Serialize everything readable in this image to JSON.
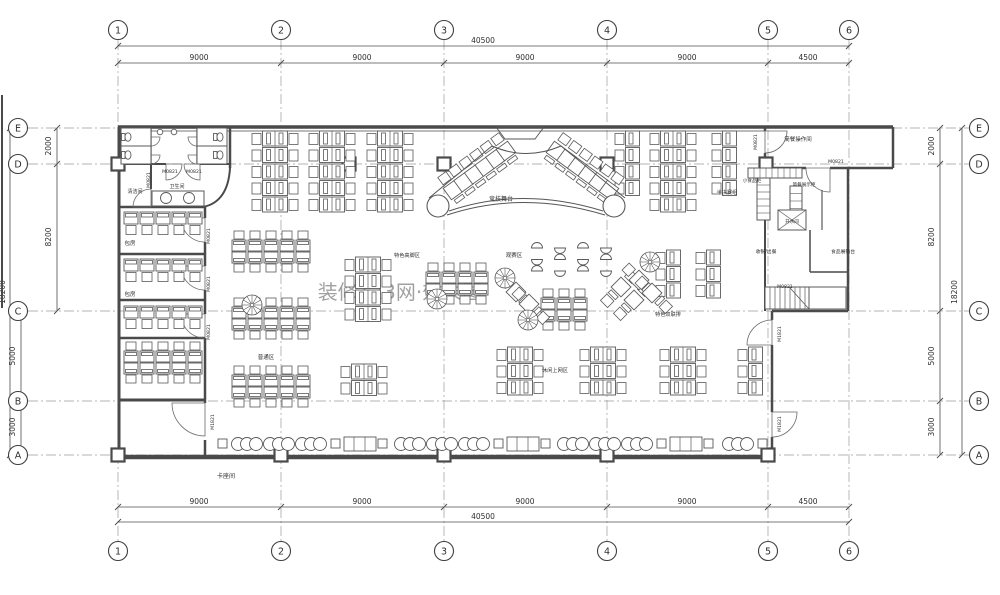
{
  "canvas": {
    "w": 1000,
    "h": 595,
    "bg": "#ffffff"
  },
  "colors": {
    "wall": "#4a4a4a",
    "line": "#555555",
    "thin": "#6a6a6a",
    "grid": "#9a9a9a",
    "dim": "#4f4f4f",
    "furn": "#5a5a5a",
    "text": "#2e2e2e",
    "watermark": "#cfc2c2"
  },
  "grid": {
    "cols": [
      [
        "1",
        118
      ],
      [
        "2",
        281
      ],
      [
        "3",
        444
      ],
      [
        "4",
        607
      ],
      [
        "5",
        768
      ],
      [
        "6",
        849
      ]
    ],
    "rows": [
      [
        "E",
        128
      ],
      [
        "D",
        164
      ],
      [
        "C",
        311
      ],
      [
        "B",
        401
      ],
      [
        "A",
        455
      ]
    ],
    "bubble_r": 9.5,
    "top_y": 30,
    "bot_y": 551,
    "left_x": 18,
    "right_x": 979,
    "line_top": 40,
    "line_bot": 541,
    "line_left": 28,
    "line_right": 969
  },
  "dims": {
    "h": [
      {
        "y": 46,
        "x1": 118,
        "x2": 849,
        "ticks": [
          118,
          849
        ],
        "labels": [
          {
            "t": "40500",
            "x": 483
          }
        ]
      },
      {
        "y": 63,
        "x1": 118,
        "x2": 849,
        "ticks": [
          118,
          281,
          444,
          607,
          768,
          849
        ],
        "labels": [
          {
            "t": "9000",
            "x": 199
          },
          {
            "t": "9000",
            "x": 362
          },
          {
            "t": "9000",
            "x": 525
          },
          {
            "t": "9000",
            "x": 687
          },
          {
            "t": "4500",
            "x": 808
          }
        ]
      },
      {
        "y": 507,
        "x1": 118,
        "x2": 849,
        "ticks": [
          118,
          281,
          444,
          607,
          768,
          849
        ],
        "labels": [
          {
            "t": "9000",
            "x": 199
          },
          {
            "t": "9000",
            "x": 362
          },
          {
            "t": "9000",
            "x": 525
          },
          {
            "t": "9000",
            "x": 687
          },
          {
            "t": "4500",
            "x": 808
          }
        ]
      },
      {
        "y": 522,
        "x1": 118,
        "x2": 849,
        "ticks": [
          118,
          849
        ],
        "labels": [
          {
            "t": "40500",
            "x": 483
          }
        ]
      }
    ],
    "v": [
      {
        "x": 57,
        "y1": 128,
        "y2": 311,
        "ticks": [
          128,
          164,
          311
        ],
        "labels": [
          {
            "t": "2000",
            "y": 146
          },
          {
            "t": "8200",
            "y": 237
          }
        ],
        "lx": 51
      },
      {
        "x": 21,
        "y1": 311,
        "y2": 455,
        "ticks": [
          311,
          401,
          455
        ],
        "labels": [
          {
            "t": "5000",
            "y": 356
          },
          {
            "t": "3000",
            "y": 427
          }
        ],
        "lx": 15
      },
      {
        "x": 10,
        "y1": 128,
        "y2": 455,
        "ticks": [
          128,
          455
        ],
        "labels": [
          {
            "t": "18200",
            "y": 292
          }
        ],
        "lx": 5
      },
      {
        "x": 940,
        "y1": 128,
        "y2": 455,
        "ticks": [
          128,
          164,
          311,
          401,
          455
        ],
        "labels": [
          {
            "t": "2000",
            "y": 146
          },
          {
            "t": "8200",
            "y": 237
          },
          {
            "t": "5000",
            "y": 356
          },
          {
            "t": "3000",
            "y": 427
          }
        ],
        "lx": 934
      },
      {
        "x": 962,
        "y1": 128,
        "y2": 455,
        "ticks": [
          128,
          455
        ],
        "labels": [
          {
            "t": "18200",
            "y": 292
          }
        ],
        "lx": 957
      }
    ]
  },
  "walls": [
    [
      118,
      127,
      893,
      127,
      3.5
    ],
    [
      118,
      131,
      765,
      131,
      0.8
    ],
    [
      119,
      127,
      119,
      456,
      3
    ],
    [
      118,
      457,
      773,
      457,
      4.5
    ],
    [
      772,
      311,
      772,
      320,
      2.5
    ],
    [
      772,
      345,
      772,
      412,
      2.5
    ],
    [
      772,
      437,
      772,
      457,
      2.5
    ],
    [
      848,
      168,
      848,
      311,
      2.5
    ],
    [
      772,
      311,
      848,
      311,
      2.5
    ],
    [
      893,
      127,
      893,
      168,
      2.5
    ],
    [
      765,
      168,
      806,
      168,
      2.5
    ],
    [
      830,
      168,
      893,
      168,
      2.5
    ],
    [
      765,
      127,
      765,
      131,
      2.5
    ],
    [
      765,
      153,
      765,
      168,
      2.5
    ],
    [
      765,
      168,
      765,
      311,
      2
    ],
    [
      230,
      127,
      230,
      168,
      2.5
    ],
    [
      119,
      164,
      151,
      164,
      2
    ],
    [
      151,
      164,
      166,
      164,
      2
    ],
    [
      200,
      164,
      230,
      164,
      2
    ],
    [
      151,
      164,
      151,
      189,
      2
    ],
    [
      119,
      207,
      205,
      207,
      2.5
    ],
    [
      119,
      254,
      205,
      254,
      2.5
    ],
    [
      119,
      300,
      205,
      300,
      2.5
    ],
    [
      119,
      338,
      205,
      338,
      2.5
    ],
    [
      119,
      400,
      205,
      400,
      3
    ],
    [
      205,
      207,
      205,
      218,
      2.5
    ],
    [
      205,
      242,
      205,
      266,
      2.5
    ],
    [
      205,
      290,
      205,
      314,
      2.5
    ],
    [
      205,
      338,
      205,
      403,
      2.5
    ],
    [
      205,
      440,
      205,
      456,
      2.5
    ],
    [
      151,
      127,
      151,
      164,
      1.3
    ],
    [
      197,
      127,
      197,
      164,
      1.3
    ],
    [
      810,
      230,
      810,
      272,
      1.5
    ],
    [
      810,
      272,
      847,
      272,
      1.5
    ]
  ],
  "wall_paths": [
    {
      "d": "M230,168 Q228,202 203,207",
      "w": 2
    }
  ],
  "doors": [
    [
      205,
      218,
      24,
      90,
      180
    ],
    [
      205,
      266,
      24,
      90,
      180
    ],
    [
      205,
      314,
      24,
      90,
      180
    ],
    [
      205,
      403,
      33,
      90,
      180
    ],
    [
      151,
      207,
      18,
      180,
      270
    ],
    [
      166,
      164,
      16,
      0,
      90
    ],
    [
      200,
      164,
      16,
      90,
      180
    ],
    [
      151,
      137,
      9,
      0,
      90
    ],
    [
      151,
      155,
      9,
      0,
      90
    ],
    [
      197,
      137,
      9,
      90,
      180
    ],
    [
      197,
      155,
      9,
      90,
      180
    ],
    [
      765,
      131,
      22,
      0,
      90
    ],
    [
      830,
      168,
      24,
      90,
      180
    ],
    [
      772,
      345,
      25,
      180,
      270
    ],
    [
      772,
      412,
      25,
      0,
      90
    ]
  ],
  "columns": [
    [
      118,
      164
    ],
    [
      349,
      164
    ],
    [
      444,
      164
    ],
    [
      607,
      164
    ],
    [
      766,
      164
    ],
    [
      118,
      455
    ],
    [
      281,
      455
    ],
    [
      444,
      455
    ],
    [
      607,
      455
    ],
    [
      768,
      455
    ]
  ],
  "cells": [
    [
      121,
      128,
      30,
      18
    ],
    [
      121,
      146,
      30,
      18
    ],
    [
      197,
      128,
      30,
      18
    ],
    [
      197,
      146,
      30,
      18
    ]
  ],
  "toilet_fixtures": [
    [
      128,
      137
    ],
    [
      128,
      155
    ],
    [
      220,
      137
    ],
    [
      220,
      155
    ]
  ],
  "urinals": [
    [
      160,
      132
    ],
    [
      174,
      132
    ]
  ],
  "sink": {
    "x": 152,
    "y": 191,
    "w": 52,
    "h": 15,
    "taps": [
      [
        166,
        198
      ],
      [
        189,
        198
      ]
    ]
  },
  "furniture": {
    "vclusters": [
      [
        252,
        131,
        5,
        0
      ],
      [
        309,
        131,
        5,
        0
      ],
      [
        367,
        131,
        5,
        0
      ],
      [
        615,
        131,
        4,
        1
      ],
      [
        650,
        131,
        5,
        0
      ],
      [
        712,
        131,
        4,
        1
      ],
      [
        345,
        257,
        4,
        0
      ],
      [
        656,
        250,
        3,
        1
      ],
      [
        696,
        250,
        3,
        1
      ],
      [
        497,
        347,
        3,
        0
      ],
      [
        580,
        347,
        3,
        0
      ],
      [
        660,
        347,
        3,
        0
      ],
      [
        738,
        347,
        3,
        1
      ],
      [
        341,
        364,
        2,
        0
      ]
    ],
    "hclusters": [
      [
        124,
        212,
        5,
        "s"
      ],
      [
        124,
        259,
        5,
        "s"
      ],
      [
        124,
        306,
        5,
        "s"
      ],
      [
        124,
        342,
        5,
        "d"
      ],
      [
        232,
        231,
        5,
        "d"
      ],
      [
        232,
        298,
        5,
        "d"
      ],
      [
        232,
        366,
        5,
        "d"
      ],
      [
        426,
        263,
        4,
        "d"
      ],
      [
        541,
        289,
        3,
        "d"
      ]
    ],
    "rotdesks": [
      [
        453,
        190,
        -36,
        0
      ],
      [
        463.6,
        182.2,
        -36,
        0
      ],
      [
        474.2,
        174.4,
        -36,
        0
      ],
      [
        484.8,
        166.6,
        -36,
        0
      ],
      [
        495.4,
        158.8,
        -36,
        0
      ],
      [
        506,
        151,
        -36,
        0
      ],
      [
        556,
        151,
        36,
        0
      ],
      [
        566.6,
        158.8,
        36,
        0
      ],
      [
        577.2,
        166.6,
        36,
        0
      ],
      [
        587.8,
        174.4,
        36,
        0
      ],
      [
        598.4,
        182.2,
        36,
        0
      ],
      [
        609,
        190,
        36,
        0
      ],
      [
        516,
        292,
        -45,
        1
      ],
      [
        529,
        304,
        -45,
        1
      ],
      [
        621,
        287,
        45,
        1
      ],
      [
        634,
        300,
        45,
        1
      ],
      [
        639,
        280,
        -45,
        1
      ],
      [
        652,
        293,
        -45,
        1
      ]
    ],
    "stools": {
      "x0": 537,
      "y0": 248,
      "dx": 23,
      "dy": 11.5,
      "cols": 4,
      "rows": 3,
      "r": 5.5
    },
    "fans": [
      [
        252,
        305
      ],
      [
        437,
        299
      ],
      [
        505,
        278
      ],
      [
        528,
        320
      ],
      [
        650,
        262
      ]
    ],
    "booth": {
      "y": 444,
      "items": [
        [
          "q",
          218
        ],
        [
          "t",
          231
        ],
        [
          "t",
          263
        ],
        [
          "t",
          295
        ],
        [
          "q",
          331
        ],
        [
          "f",
          344
        ],
        [
          "q",
          378
        ],
        [
          "t",
          394
        ],
        [
          "t",
          426
        ],
        [
          "t",
          458
        ],
        [
          "q",
          494
        ],
        [
          "f",
          507
        ],
        [
          "q",
          541
        ],
        [
          "t",
          557
        ],
        [
          "t",
          589
        ],
        [
          "t",
          621
        ],
        [
          "q",
          657
        ],
        [
          "f",
          670
        ],
        [
          "q",
          704
        ],
        [
          "t",
          722
        ],
        [
          "q",
          758
        ]
      ]
    },
    "stage": {
      "endCircles": [
        [
          438,
          206,
          11
        ],
        [
          614,
          206,
          11
        ]
      ],
      "curves": [
        "M447,215 Q522,190 605,215",
        "M449,211 Q522,186 603,211"
      ],
      "lines": [
        [
          429,
          198,
          492,
          146
        ],
        [
          625,
          198,
          561,
          146
        ]
      ],
      "apex": "M492,146 Q526,161 561,146",
      "podium": "M496,127 L544,127 L535,139 L505,139 Z"
    },
    "stairs": [
      {
        "x": 765,
        "y": 287,
        "w": 44,
        "h": 22,
        "step": 5,
        "diag": 1
      },
      {
        "x": 809,
        "y": 287,
        "w": 37,
        "h": 22,
        "step": 0,
        "diag": 0
      }
    ],
    "counters": [
      [
        748,
        168,
        54,
        10,
        "v",
        6
      ],
      [
        757,
        178,
        13,
        42,
        "h",
        7
      ],
      [
        790,
        186,
        12,
        44,
        "h",
        7.5
      ]
    ],
    "xbox": [
      778,
      210,
      28,
      20
    ],
    "lshape": "M822,190 L822,230 M810,230 L810,272 M810,272 L847,272"
  },
  "labels": [
    [
      "清洁间",
      135,
      193,
      5,
      0
    ],
    [
      "卫生间",
      177,
      188,
      5,
      0
    ],
    [
      "M0821",
      170,
      173,
      4.6,
      0
    ],
    [
      "M0821",
      194,
      173,
      4.6,
      0
    ],
    [
      "M0821",
      150,
      180,
      4.6,
      -90
    ],
    [
      "包房",
      130,
      245,
      5.5,
      0
    ],
    [
      "包房",
      130,
      296,
      5.5,
      0
    ],
    [
      "M0821",
      210,
      236,
      4.6,
      -90
    ],
    [
      "M0821",
      210,
      284,
      4.6,
      -90
    ],
    [
      "M0821",
      210,
      332,
      4.6,
      -90
    ],
    [
      "M1821",
      214,
      422,
      4.6,
      -90
    ],
    [
      "卡座间",
      226,
      478,
      6,
      0
    ],
    [
      "普通区",
      266,
      359,
      5.5,
      0
    ],
    [
      "竞技舞台",
      501,
      201,
      6,
      0
    ],
    [
      "观赛区",
      514,
      257,
      5.5,
      0
    ],
    [
      "特色高脚区",
      407,
      257,
      5.2,
      0
    ],
    [
      "特色双联排",
      668,
      316,
      5.2,
      0
    ],
    [
      "半决赛组",
      727,
      194,
      5.2,
      0
    ],
    [
      "休闲上网区",
      555,
      372,
      5.2,
      0
    ],
    [
      "M0821",
      757,
      142,
      4.6,
      -90
    ],
    [
      "简餐操作间",
      798,
      141,
      5.5,
      0
    ],
    [
      "M0821",
      836,
      163,
      4.6,
      0
    ],
    [
      "小食品柜",
      752,
      182,
      4.6,
      0
    ],
    [
      "简餐展示柜",
      804,
      186,
      4.6,
      0
    ],
    [
      "开水间",
      792,
      223,
      4.6,
      0
    ],
    [
      "收银/出餐",
      766,
      253,
      4.8,
      0
    ],
    [
      "食品展销台",
      843,
      253,
      4.8,
      0
    ],
    [
      "M0821",
      785,
      288,
      4.6,
      0
    ],
    [
      "M1821",
      781,
      334,
      4.6,
      -90
    ],
    [
      "M1821",
      781,
      424,
      4.6,
      -90
    ]
  ],
  "watermark": {
    "t": "装修123网·效果图",
    "x": 400,
    "y": 299,
    "s": 20
  },
  "scanline": [
    2,
    95,
    2,
    308
  ]
}
